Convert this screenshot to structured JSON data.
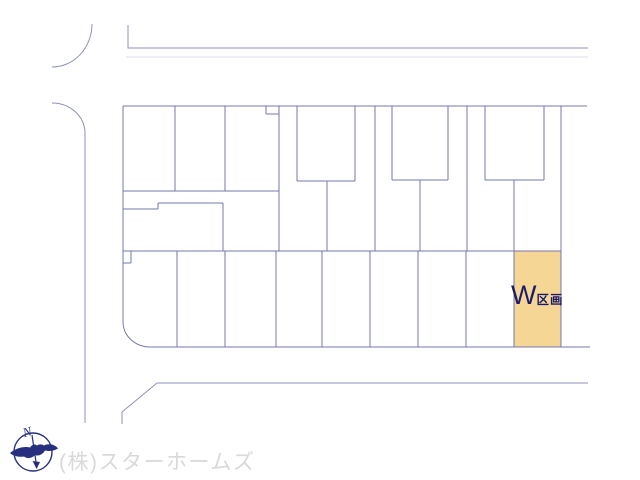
{
  "highlighted_lot": {
    "name": "W",
    "label_suffix": "区画"
  },
  "company": {
    "name": "(株)スターホームズ"
  },
  "compass": {
    "north": "N"
  },
  "colors": {
    "background": "#ffffff",
    "road-line": "#8f91bd",
    "faint-line": "#dcdce8",
    "parcel-line": "#7477ad",
    "highlight-fill": "#f6d694",
    "highlight-label": "#1b1b6b",
    "logo-navy": "#27307e",
    "company-text": "#d9d9d9"
  }
}
